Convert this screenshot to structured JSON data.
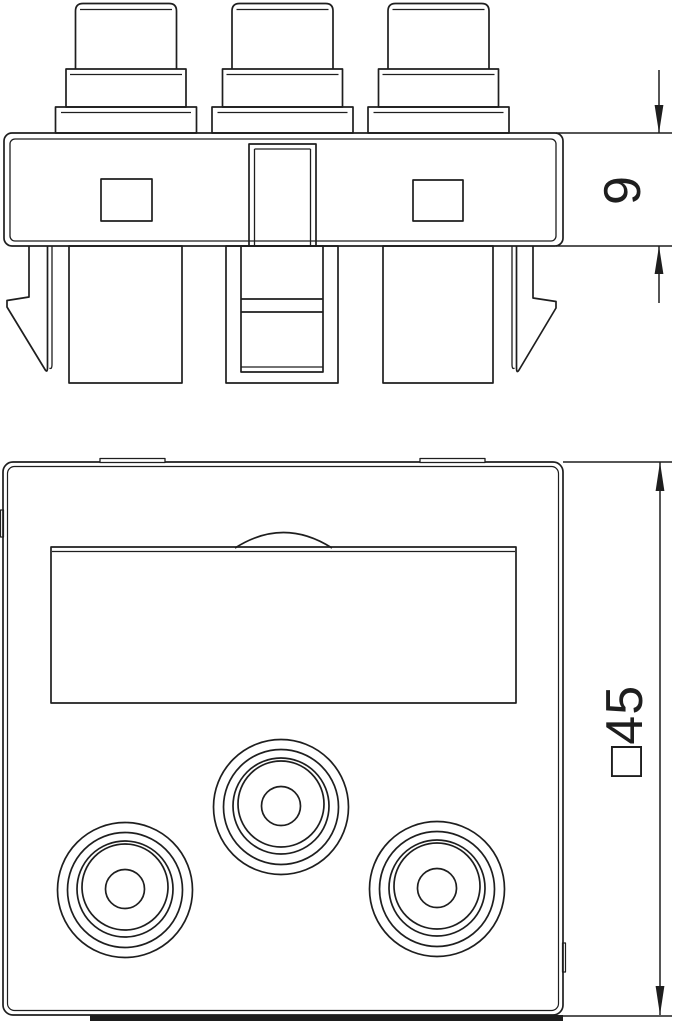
{
  "colors": {
    "line": "#1e1e1e",
    "background": "#ffffff"
  },
  "side_view": {
    "dimension_label": "9"
  },
  "front_view": {
    "dimension_label": "□45"
  }
}
